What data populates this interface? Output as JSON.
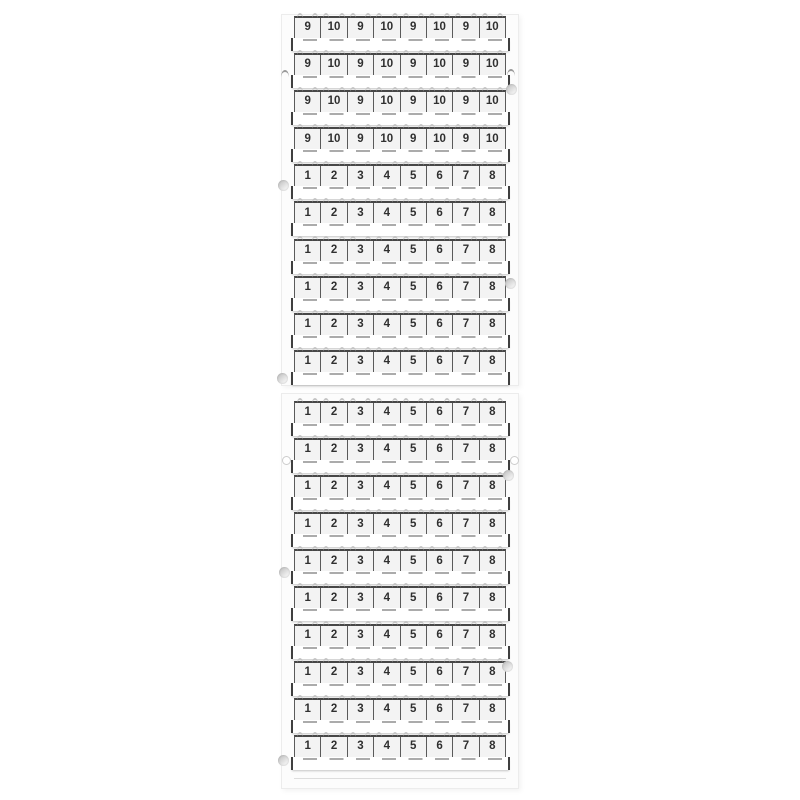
{
  "colors": {
    "background": "#ffffff",
    "card": "#fcfcfc",
    "tag_fill": "#f3f3f3",
    "outline": "#474747",
    "digit": "#303030",
    "nub": "#ababab"
  },
  "cards": [
    {
      "name": "top",
      "rows": [
        [
          "9",
          "10",
          "9",
          "10",
          "9",
          "10",
          "9",
          "10"
        ],
        [
          "9",
          "10",
          "9",
          "10",
          "9",
          "10",
          "9",
          "10"
        ],
        [
          "9",
          "10",
          "9",
          "10",
          "9",
          "10",
          "9",
          "10"
        ],
        [
          "9",
          "10",
          "9",
          "10",
          "9",
          "10",
          "9",
          "10"
        ],
        [
          "1",
          "2",
          "3",
          "4",
          "5",
          "6",
          "7",
          "8"
        ],
        [
          "1",
          "2",
          "3",
          "4",
          "5",
          "6",
          "7",
          "8"
        ],
        [
          "1",
          "2",
          "3",
          "4",
          "5",
          "6",
          "7",
          "8"
        ],
        [
          "1",
          "2",
          "3",
          "4",
          "5",
          "6",
          "7",
          "8"
        ],
        [
          "1",
          "2",
          "3",
          "4",
          "5",
          "6",
          "7",
          "8"
        ],
        [
          "1",
          "2",
          "3",
          "4",
          "5",
          "6",
          "7",
          "8"
        ]
      ]
    },
    {
      "name": "bottom",
      "rows": [
        [
          "1",
          "2",
          "3",
          "4",
          "5",
          "6",
          "7",
          "8"
        ],
        [
          "1",
          "2",
          "3",
          "4",
          "5",
          "6",
          "7",
          "8"
        ],
        [
          "1",
          "2",
          "3",
          "4",
          "5",
          "6",
          "7",
          "8"
        ],
        [
          "1",
          "2",
          "3",
          "4",
          "5",
          "6",
          "7",
          "8"
        ],
        [
          "1",
          "2",
          "3",
          "4",
          "5",
          "6",
          "7",
          "8"
        ],
        [
          "1",
          "2",
          "3",
          "4",
          "5",
          "6",
          "7",
          "8"
        ],
        [
          "1",
          "2",
          "3",
          "4",
          "5",
          "6",
          "7",
          "8"
        ],
        [
          "1",
          "2",
          "3",
          "4",
          "5",
          "6",
          "7",
          "8"
        ],
        [
          "1",
          "2",
          "3",
          "4",
          "5",
          "6",
          "7",
          "8"
        ],
        [
          "1",
          "2",
          "3",
          "4",
          "5",
          "6",
          "7",
          "8"
        ]
      ]
    }
  ]
}
